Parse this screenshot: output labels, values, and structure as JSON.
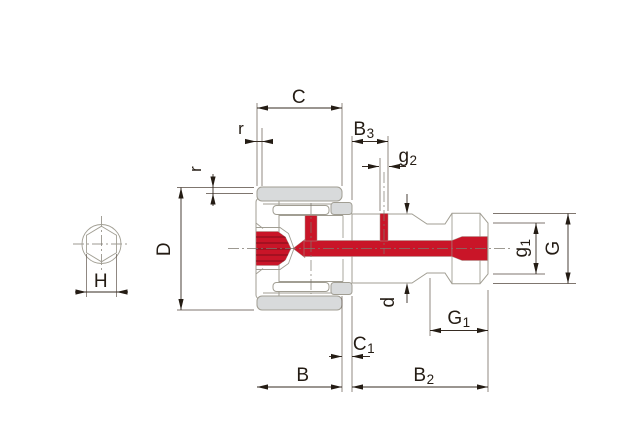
{
  "drawing": {
    "title": "stud-type cam follower cross-section drawing",
    "colors": {
      "highlight_red": "#c91528",
      "part_gray": "#d8dadb",
      "outline_gray": "#a19e93",
      "dimension_dark": "#362b22"
    },
    "dims": {
      "C": {
        "main": "C",
        "sub": ""
      },
      "r_top": {
        "main": "r",
        "sub": ""
      },
      "r_left": {
        "main": "r",
        "sub": ""
      },
      "B3": {
        "main": "B",
        "sub": "3"
      },
      "g2": {
        "main": "g",
        "sub": "2"
      },
      "D": {
        "main": "D",
        "sub": ""
      },
      "H": {
        "main": "H",
        "sub": ""
      },
      "d": {
        "main": "d",
        "sub": ""
      },
      "C1": {
        "main": "C",
        "sub": "1"
      },
      "G1": {
        "main": "G",
        "sub": "1"
      },
      "B": {
        "main": "B",
        "sub": ""
      },
      "B2": {
        "main": "B",
        "sub": "2"
      },
      "g1": {
        "main": "g",
        "sub": "1"
      },
      "G": {
        "main": "G",
        "sub": ""
      }
    }
  }
}
